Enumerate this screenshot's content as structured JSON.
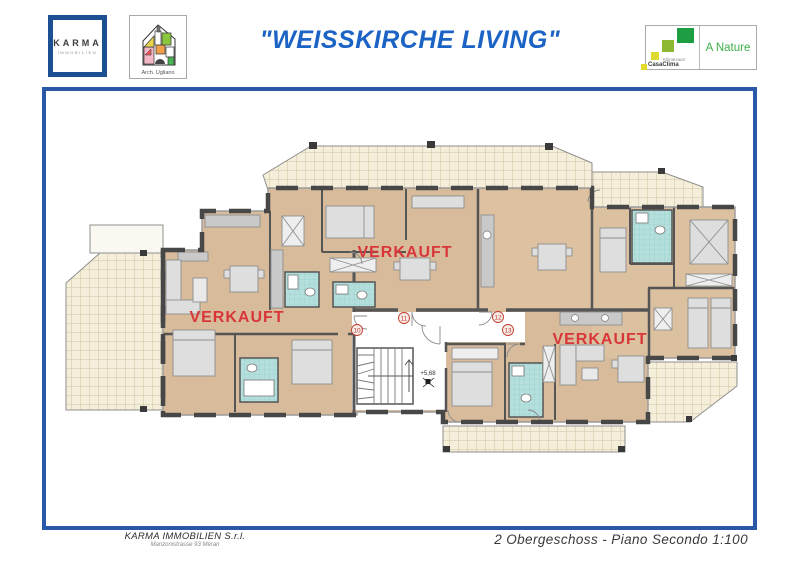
{
  "header": {
    "karma_logo": {
      "line1": "KARMA",
      "line2": "IMMOBILIEN"
    },
    "arch_logo": {
      "caption": "Arch. Ugliano"
    },
    "title": "\"WEISSKIRCHE LIVING\"",
    "klima_logo": {
      "brand_small": "KlimaHaus'",
      "brand_bold": "CasaClima",
      "rating": "A Nature"
    }
  },
  "plan": {
    "sold_labels": [
      "VERKAUFT",
      "VERKAUFT",
      "VERKAUFT"
    ],
    "unit_numbers": [
      "10",
      "11",
      "12",
      "13"
    ],
    "elevation_marker": "+5,68"
  },
  "footer": {
    "company": "KARMA IMMOBILIEN S.r.l.",
    "address": "Manzonistrasse 93 Meran",
    "caption": "2 Obergeschoss - Piano Secondo  1:100"
  },
  "colors": {
    "title_blue": "#1b63c4",
    "frame_blue": "#2b57a7",
    "sold_red": "#d9363a",
    "room_beige": "#d7bb9a",
    "terrace_cream": "#f4eeda",
    "bath_teal": "#b5dfdc",
    "casaclima_green": "#1e9e43"
  }
}
